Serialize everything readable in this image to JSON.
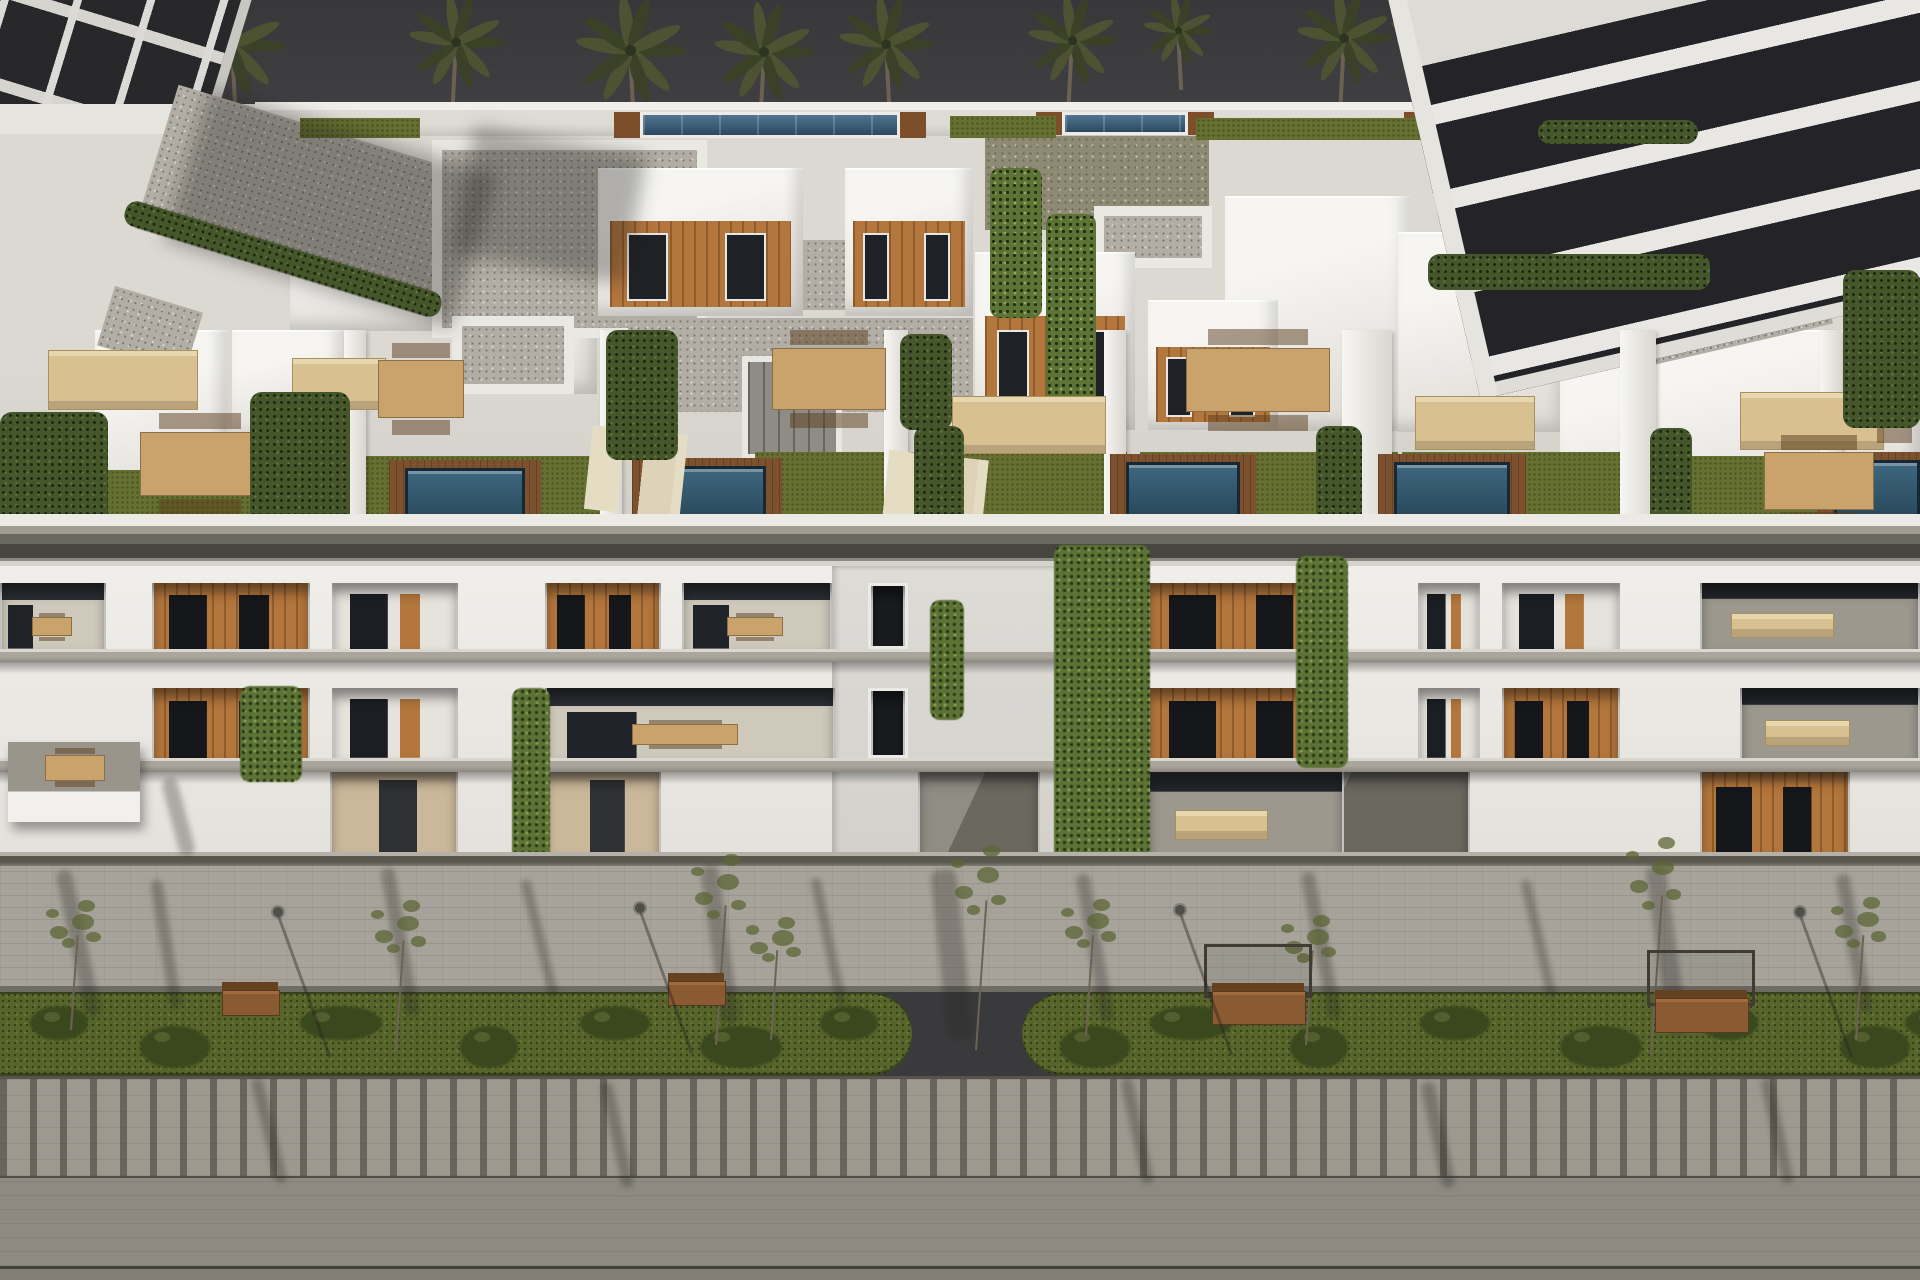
{
  "palette": {
    "sky": "#3a3a3c",
    "building_white": "#efede9",
    "gravel_roof": "#b2ada5",
    "wood_panel": "#b3763c",
    "pool_water": "#2c4c62",
    "roof_turf": "#667031",
    "hedge_green": "#45562b",
    "grass_strip": "#57652b",
    "pavement": "#a7a39b",
    "wood_deck": "#7d512d",
    "furniture_beige": "#d9c091",
    "neighbor_dark": "#28282a"
  },
  "sky": {
    "palms": [
      {
        "x": 232,
        "y": 46,
        "s": 1.05,
        "t": 110
      },
      {
        "x": 456,
        "y": 42,
        "s": 0.95,
        "t": 80
      },
      {
        "x": 630,
        "y": 50,
        "s": 1.1,
        "t": 70
      },
      {
        "x": 764,
        "y": 52,
        "s": 1.0,
        "t": 66
      },
      {
        "x": 886,
        "y": 44,
        "s": 0.95,
        "t": 70
      },
      {
        "x": 1072,
        "y": 40,
        "s": 0.9,
        "t": 70
      },
      {
        "x": 1178,
        "y": 30,
        "s": 0.7,
        "t": 60
      },
      {
        "x": 1344,
        "y": 38,
        "s": 0.95,
        "t": 64
      },
      {
        "x": 1428,
        "y": 30,
        "s": 0.75,
        "t": 56
      },
      {
        "x": 1790,
        "y": 26,
        "s": 0.8,
        "t": 40
      },
      {
        "x": 1868,
        "y": 34,
        "s": 0.85,
        "t": 44
      }
    ]
  },
  "roof": {
    "gravel": [
      {
        "x": 150,
        "y": 126,
        "w": 305,
        "h": 150,
        "rot": 17
      },
      {
        "x": 432,
        "y": 140,
        "w": 275,
        "h": 198,
        "frame": true
      },
      {
        "x": 985,
        "y": 136,
        "w": 224,
        "h": 94,
        "green": true
      },
      {
        "x": 628,
        "y": 318,
        "w": 345,
        "h": 94
      },
      {
        "x": 1094,
        "y": 206,
        "w": 118,
        "h": 62,
        "frame": true
      },
      {
        "x": 452,
        "y": 316,
        "w": 122,
        "h": 78,
        "frame": true
      },
      {
        "x": 735,
        "y": 240,
        "w": 122,
        "h": 70
      },
      {
        "x": 1618,
        "y": 236,
        "w": 205,
        "h": 112,
        "rot": -13
      },
      {
        "x": 1838,
        "y": 126,
        "w": 85,
        "h": 95,
        "rot": -13
      },
      {
        "x": 104,
        "y": 298,
        "w": 92,
        "h": 62,
        "rot": 17
      }
    ],
    "pools": [
      {
        "x": 640,
        "y": 112,
        "w": 260,
        "h": 26
      },
      {
        "x": 1062,
        "y": 112,
        "w": 126,
        "h": 23
      },
      {
        "x": 1430,
        "y": 112,
        "w": 96,
        "h": 21
      }
    ],
    "turf": [
      {
        "x": 950,
        "y": 116,
        "w": 106,
        "h": 22
      },
      {
        "x": 1196,
        "y": 118,
        "w": 228,
        "h": 22
      },
      {
        "x": 1532,
        "y": 118,
        "w": 92,
        "h": 22
      },
      {
        "x": 300,
        "y": 118,
        "w": 120,
        "h": 20
      }
    ],
    "whitevols": [
      {
        "x": 290,
        "y": 196,
        "w": 155,
        "h": 135
      },
      {
        "x": 505,
        "y": 232,
        "w": 92,
        "h": 162
      },
      {
        "x": 1225,
        "y": 196,
        "w": 185,
        "h": 235
      },
      {
        "x": 1398,
        "y": 232,
        "w": 168,
        "h": 200
      },
      {
        "x": 1560,
        "y": 330,
        "w": 360,
        "h": 185
      },
      {
        "x": 95,
        "y": 330,
        "w": 132,
        "h": 185
      },
      {
        "x": 232,
        "y": 330,
        "w": 112,
        "h": 112
      }
    ],
    "penthouses": [
      {
        "x": 598,
        "y": 168,
        "w": 205,
        "h": 148
      },
      {
        "x": 845,
        "y": 168,
        "w": 128,
        "h": 148
      },
      {
        "x": 975,
        "y": 252,
        "w": 160,
        "h": 178
      },
      {
        "x": 1148,
        "y": 300,
        "w": 130,
        "h": 130
      }
    ],
    "core": {
      "x": 742,
      "y": 356,
      "w": 100,
      "h": 104
    },
    "ivy": [
      {
        "x": 990,
        "y": 168,
        "w": 52,
        "h": 150
      },
      {
        "x": 1046,
        "y": 214,
        "w": 50,
        "h": 216
      }
    ],
    "shadows": [
      {
        "x": 180,
        "y": 128,
        "w": 300,
        "h": 160,
        "rot": 17
      },
      {
        "x": 462,
        "y": 140,
        "w": 175,
        "h": 130,
        "rot": 10
      },
      {
        "x": 1535,
        "y": 105,
        "w": 265,
        "h": 175,
        "rot": -13
      }
    ]
  },
  "terrace": {
    "turf": [
      {
        "x": 345,
        "y": 456,
        "w": 268,
        "h": 88
      },
      {
        "x": 755,
        "y": 452,
        "w": 372,
        "h": 92
      },
      {
        "x": 1140,
        "y": 452,
        "w": 258,
        "h": 92
      },
      {
        "x": 1402,
        "y": 452,
        "w": 218,
        "h": 92
      },
      {
        "x": 1658,
        "y": 456,
        "w": 182,
        "h": 88
      },
      {
        "x": 55,
        "y": 470,
        "w": 195,
        "h": 74
      }
    ],
    "pools": [
      {
        "x": 405,
        "y": 468,
        "w": 120,
        "h": 70
      },
      {
        "x": 648,
        "y": 466,
        "w": 118,
        "h": 72
      },
      {
        "x": 1126,
        "y": 462,
        "w": 114,
        "h": 72
      },
      {
        "x": 1394,
        "y": 462,
        "w": 116,
        "h": 74
      },
      {
        "x": 1834,
        "y": 460,
        "w": 86,
        "h": 78
      }
    ],
    "furniture": [
      {
        "k": "sofa",
        "x": 48,
        "y": 350,
        "w": 148,
        "h": 58
      },
      {
        "k": "table",
        "x": 140,
        "y": 432,
        "w": 118,
        "h": 62
      },
      {
        "k": "sofa",
        "x": 292,
        "y": 358,
        "w": 92,
        "h": 50
      },
      {
        "k": "table",
        "x": 378,
        "y": 360,
        "w": 84,
        "h": 56
      },
      {
        "k": "lounge",
        "x": 588,
        "y": 430,
        "w": 96,
        "h": 84
      },
      {
        "k": "table",
        "x": 772,
        "y": 348,
        "w": 112,
        "h": 60
      },
      {
        "k": "sofa",
        "x": 952,
        "y": 396,
        "w": 152,
        "h": 56
      },
      {
        "k": "lounge",
        "x": 885,
        "y": 455,
        "w": 100,
        "h": 78
      },
      {
        "k": "table",
        "x": 1186,
        "y": 348,
        "w": 142,
        "h": 62
      },
      {
        "k": "sofa",
        "x": 1415,
        "y": 396,
        "w": 118,
        "h": 52
      },
      {
        "k": "sofa",
        "x": 1740,
        "y": 392,
        "w": 142,
        "h": 56
      },
      {
        "k": "table",
        "x": 1764,
        "y": 452,
        "w": 108,
        "h": 56
      },
      {
        "k": "table",
        "x": 1868,
        "y": 344,
        "w": 50,
        "h": 74
      }
    ],
    "hedges": [
      {
        "x": 0,
        "y": 412,
        "w": 108,
        "h": 132
      },
      {
        "x": 250,
        "y": 392,
        "w": 100,
        "h": 152
      },
      {
        "x": 606,
        "y": 330,
        "w": 72,
        "h": 130
      },
      {
        "x": 900,
        "y": 334,
        "w": 52,
        "h": 96
      },
      {
        "x": 914,
        "y": 426,
        "w": 50,
        "h": 118
      },
      {
        "x": 1316,
        "y": 426,
        "w": 46,
        "h": 114
      },
      {
        "x": 1650,
        "y": 428,
        "w": 42,
        "h": 110
      },
      {
        "x": 1843,
        "y": 270,
        "w": 77,
        "h": 158
      },
      {
        "x": 1428,
        "y": 254,
        "w": 282,
        "h": 36
      },
      {
        "x": 1538,
        "y": 120,
        "w": 160,
        "h": 24
      },
      {
        "x": 118,
        "y": 246,
        "w": 330,
        "h": 26,
        "rot": 17
      }
    ],
    "walls": [
      {
        "x": 344,
        "y": 330,
        "w": 22,
        "h": 214
      },
      {
        "x": 600,
        "y": 330,
        "w": 22,
        "h": 214
      },
      {
        "x": 884,
        "y": 330,
        "w": 24,
        "h": 214
      },
      {
        "x": 1104,
        "y": 330,
        "w": 22,
        "h": 214
      },
      {
        "x": 1342,
        "y": 330,
        "w": 50,
        "h": 214
      },
      {
        "x": 1620,
        "y": 330,
        "w": 36,
        "h": 214
      },
      {
        "x": 1820,
        "y": 330,
        "w": 22,
        "h": 214
      }
    ]
  },
  "facade": {
    "row1": {
      "y": 583,
      "h": 66,
      "openings": [
        {
          "x": 0,
          "w": 106,
          "k": "terr"
        },
        {
          "x": 152,
          "w": 158,
          "k": "wood"
        },
        {
          "x": 332,
          "w": 126,
          "k": "mix"
        },
        {
          "x": 545,
          "w": 116,
          "k": "wood"
        },
        {
          "x": 682,
          "w": 150,
          "k": "terr"
        },
        {
          "x": 868,
          "w": 40,
          "k": "win"
        },
        {
          "x": 1148,
          "w": 196,
          "k": "wood"
        },
        {
          "x": 1418,
          "w": 62,
          "k": "mix"
        },
        {
          "x": 1502,
          "w": 118,
          "k": "mix"
        },
        {
          "x": 1700,
          "w": 220,
          "k": "terr2"
        }
      ]
    },
    "row2": {
      "y": 688,
      "h": 70,
      "openings": [
        {
          "x": 152,
          "w": 158,
          "k": "wood"
        },
        {
          "x": 332,
          "w": 126,
          "k": "mix"
        },
        {
          "x": 545,
          "w": 290,
          "k": "terr"
        },
        {
          "x": 868,
          "w": 40,
          "k": "win"
        },
        {
          "x": 1148,
          "w": 196,
          "k": "wood"
        },
        {
          "x": 1418,
          "w": 62,
          "k": "mix"
        },
        {
          "x": 1502,
          "w": 118,
          "k": "wood"
        },
        {
          "x": 1740,
          "w": 180,
          "k": "terr2"
        }
      ]
    },
    "ground": {
      "y": 772,
      "h": 82,
      "openings": [
        {
          "x": 330,
          "w": 128,
          "k": "door"
        },
        {
          "x": 545,
          "w": 116,
          "k": "door"
        },
        {
          "x": 918,
          "w": 122,
          "k": "court"
        },
        {
          "x": 1238,
          "w": 232,
          "k": "court"
        },
        {
          "x": 1700,
          "w": 150,
          "k": "wood"
        },
        {
          "x": 1148,
          "w": 196,
          "k": "terr2"
        }
      ]
    },
    "slabs": [
      {
        "y": 649,
        "h": 13
      },
      {
        "y": 758,
        "h": 14
      }
    ],
    "balcony_box": {
      "x": 8,
      "y": 742,
      "w": 132,
      "h": 80
    },
    "vines": [
      {
        "x": 1054,
        "y": 545,
        "w": 96,
        "h": 330
      },
      {
        "x": 1296,
        "y": 556,
        "w": 52,
        "h": 212
      },
      {
        "x": 512,
        "y": 688,
        "w": 38,
        "h": 178
      },
      {
        "x": 240,
        "y": 686,
        "w": 62,
        "h": 96
      },
      {
        "x": 930,
        "y": 600,
        "w": 34,
        "h": 120
      }
    ]
  },
  "street": {
    "benches": [
      {
        "x": 222,
        "y": 968,
        "w": 56,
        "h": 54,
        "pergola": false
      },
      {
        "x": 668,
        "y": 960,
        "w": 56,
        "h": 52,
        "pergola": false
      },
      {
        "x": 1212,
        "y": 962,
        "w": 92,
        "h": 72,
        "pergola": true
      },
      {
        "x": 1655,
        "y": 968,
        "w": 92,
        "h": 74,
        "pergola": true
      }
    ],
    "lamps": [
      {
        "x": 278,
        "y": 912
      },
      {
        "x": 640,
        "y": 908
      },
      {
        "x": 1180,
        "y": 910
      },
      {
        "x": 1800,
        "y": 912
      }
    ],
    "trees": [
      {
        "x": 70,
        "y": 935,
        "h": 95
      },
      {
        "x": 395,
        "y": 940,
        "h": 110
      },
      {
        "x": 715,
        "y": 905,
        "h": 140
      },
      {
        "x": 770,
        "y": 950,
        "h": 90
      },
      {
        "x": 975,
        "y": 900,
        "h": 150
      },
      {
        "x": 1085,
        "y": 935,
        "h": 100
      },
      {
        "x": 1305,
        "y": 950,
        "h": 95
      },
      {
        "x": 1650,
        "y": 895,
        "h": 160
      },
      {
        "x": 1855,
        "y": 935,
        "h": 105
      }
    ],
    "bushes_left": [
      30,
      140,
      300,
      460,
      580,
      700,
      820
    ],
    "bushes_right": [
      1060,
      1150,
      1290,
      1420,
      1560,
      1700,
      1840,
      1905
    ],
    "shadows": [
      {
        "x": 55,
        "y": 870,
        "w": 16,
        "h": 150,
        "rot": 12
      },
      {
        "x": 150,
        "y": 880,
        "w": 12,
        "h": 130,
        "rot": 9
      },
      {
        "x": 380,
        "y": 868,
        "w": 14,
        "h": 150,
        "rot": 10
      },
      {
        "x": 520,
        "y": 880,
        "w": 10,
        "h": 120,
        "rot": 14
      },
      {
        "x": 700,
        "y": 866,
        "w": 18,
        "h": 160,
        "rot": 8
      },
      {
        "x": 810,
        "y": 878,
        "w": 10,
        "h": 130,
        "rot": 12
      },
      {
        "x": 930,
        "y": 870,
        "w": 26,
        "h": 170,
        "rot": 6
      },
      {
        "x": 1075,
        "y": 874,
        "w": 14,
        "h": 150,
        "rot": 10
      },
      {
        "x": 1300,
        "y": 872,
        "w": 14,
        "h": 150,
        "rot": 11
      },
      {
        "x": 1520,
        "y": 880,
        "w": 10,
        "h": 120,
        "rot": 13
      },
      {
        "x": 1645,
        "y": 866,
        "w": 20,
        "h": 170,
        "rot": 8
      },
      {
        "x": 1835,
        "y": 874,
        "w": 14,
        "h": 140,
        "rot": 10
      },
      {
        "x": 160,
        "y": 778,
        "w": 16,
        "h": 80,
        "rot": 15
      },
      {
        "x": 250,
        "y": 1078,
        "w": 12,
        "h": 108,
        "rot": 14
      },
      {
        "x": 600,
        "y": 1082,
        "w": 12,
        "h": 108,
        "rot": 12
      },
      {
        "x": 1120,
        "y": 1078,
        "w": 12,
        "h": 108,
        "rot": 12
      },
      {
        "x": 1420,
        "y": 1082,
        "w": 14,
        "h": 108,
        "rot": 12
      },
      {
        "x": 1760,
        "y": 1078,
        "w": 12,
        "h": 108,
        "rot": 12
      }
    ]
  }
}
